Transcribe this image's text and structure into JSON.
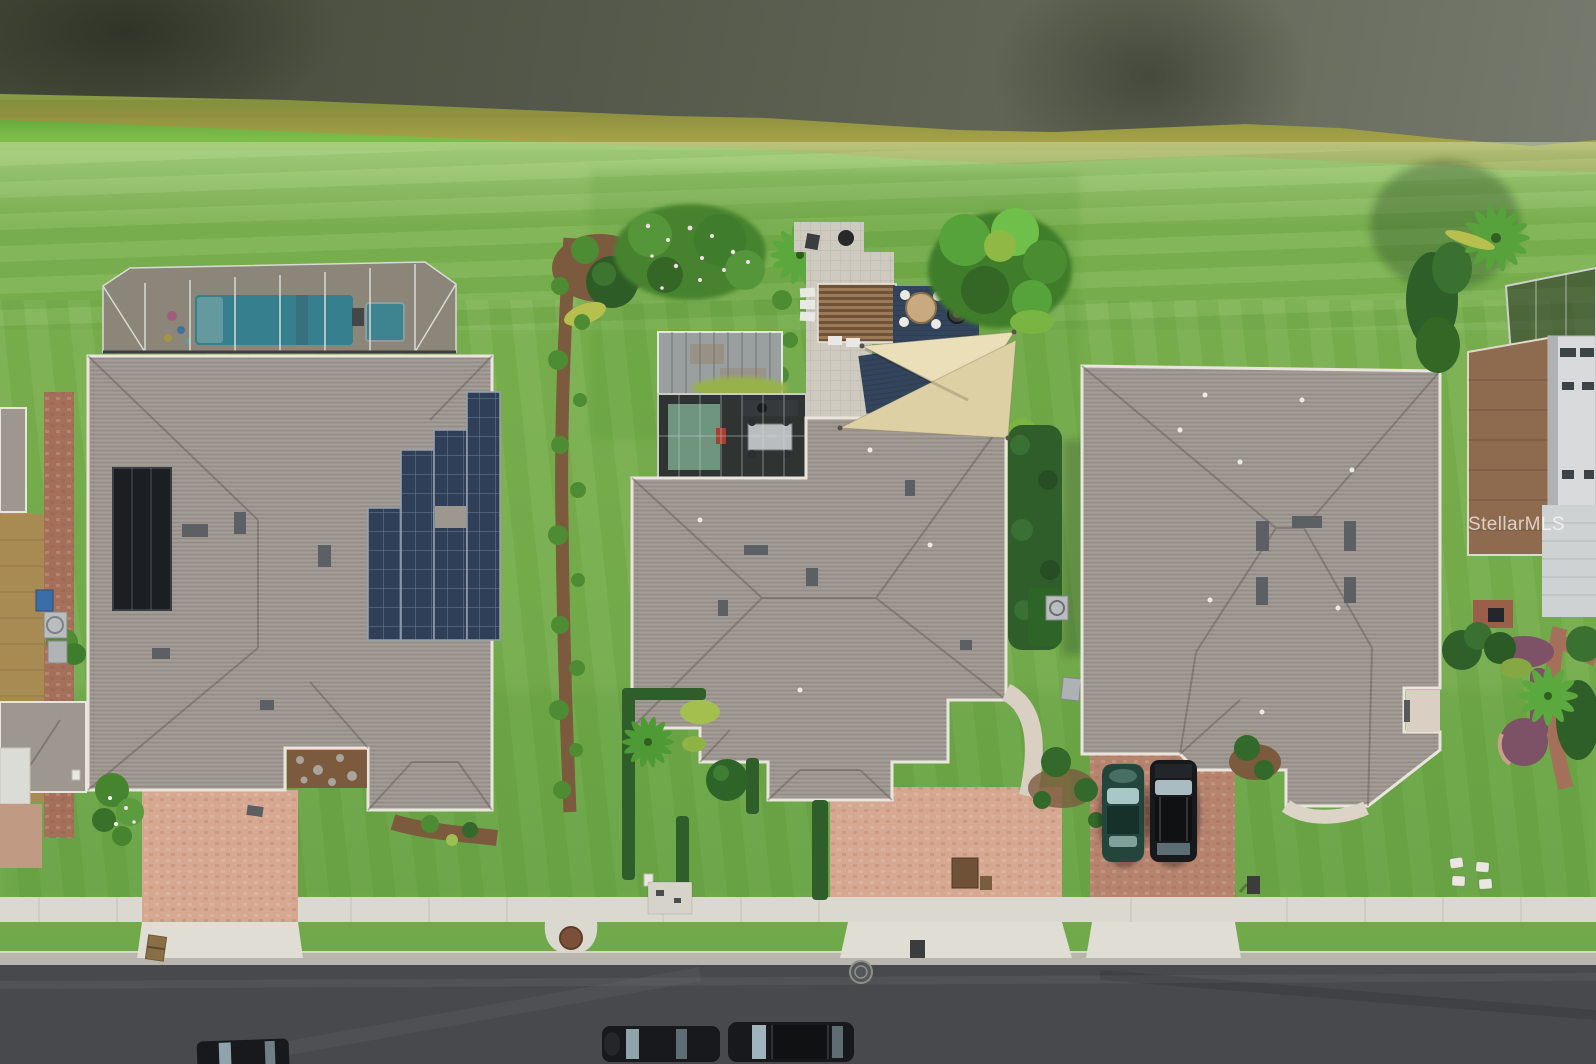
{
  "watermark": {
    "text": "StellarMLS"
  },
  "palette": {
    "water-dark": "#454a3a",
    "water-light": "#767a6e",
    "algae": "#a5a348",
    "shore": "#7cbc4b",
    "lawn": "#76ad4c",
    "lawn-dark": "#4f8f33",
    "roof": "#9e9790",
    "fascia": "#e9e5dd",
    "solar": "#2f3f58",
    "thermal": "#1b1e22",
    "pool": "#34a6c4",
    "cage-deck": "#bdb2a0",
    "pergola": "#8a6847",
    "deck": "#33455c",
    "sail": "#ebdfba",
    "pavers-pink": "#d6a791",
    "pavers-red": "#b5836e",
    "concrete": "#dbd8cf",
    "road": "#47494c",
    "hedge": "#2f5e2b",
    "mulch": "#7b5a3e",
    "mulch-purple": "#7d5266",
    "plant": "#4e8c33",
    "metal": "#9aa0a0",
    "tan-roof": "#a78b52",
    "brick": "#a5705a",
    "car-black": "#17191d",
    "car-teal": "#2a4a42",
    "trim-white": "#d8dadb"
  }
}
